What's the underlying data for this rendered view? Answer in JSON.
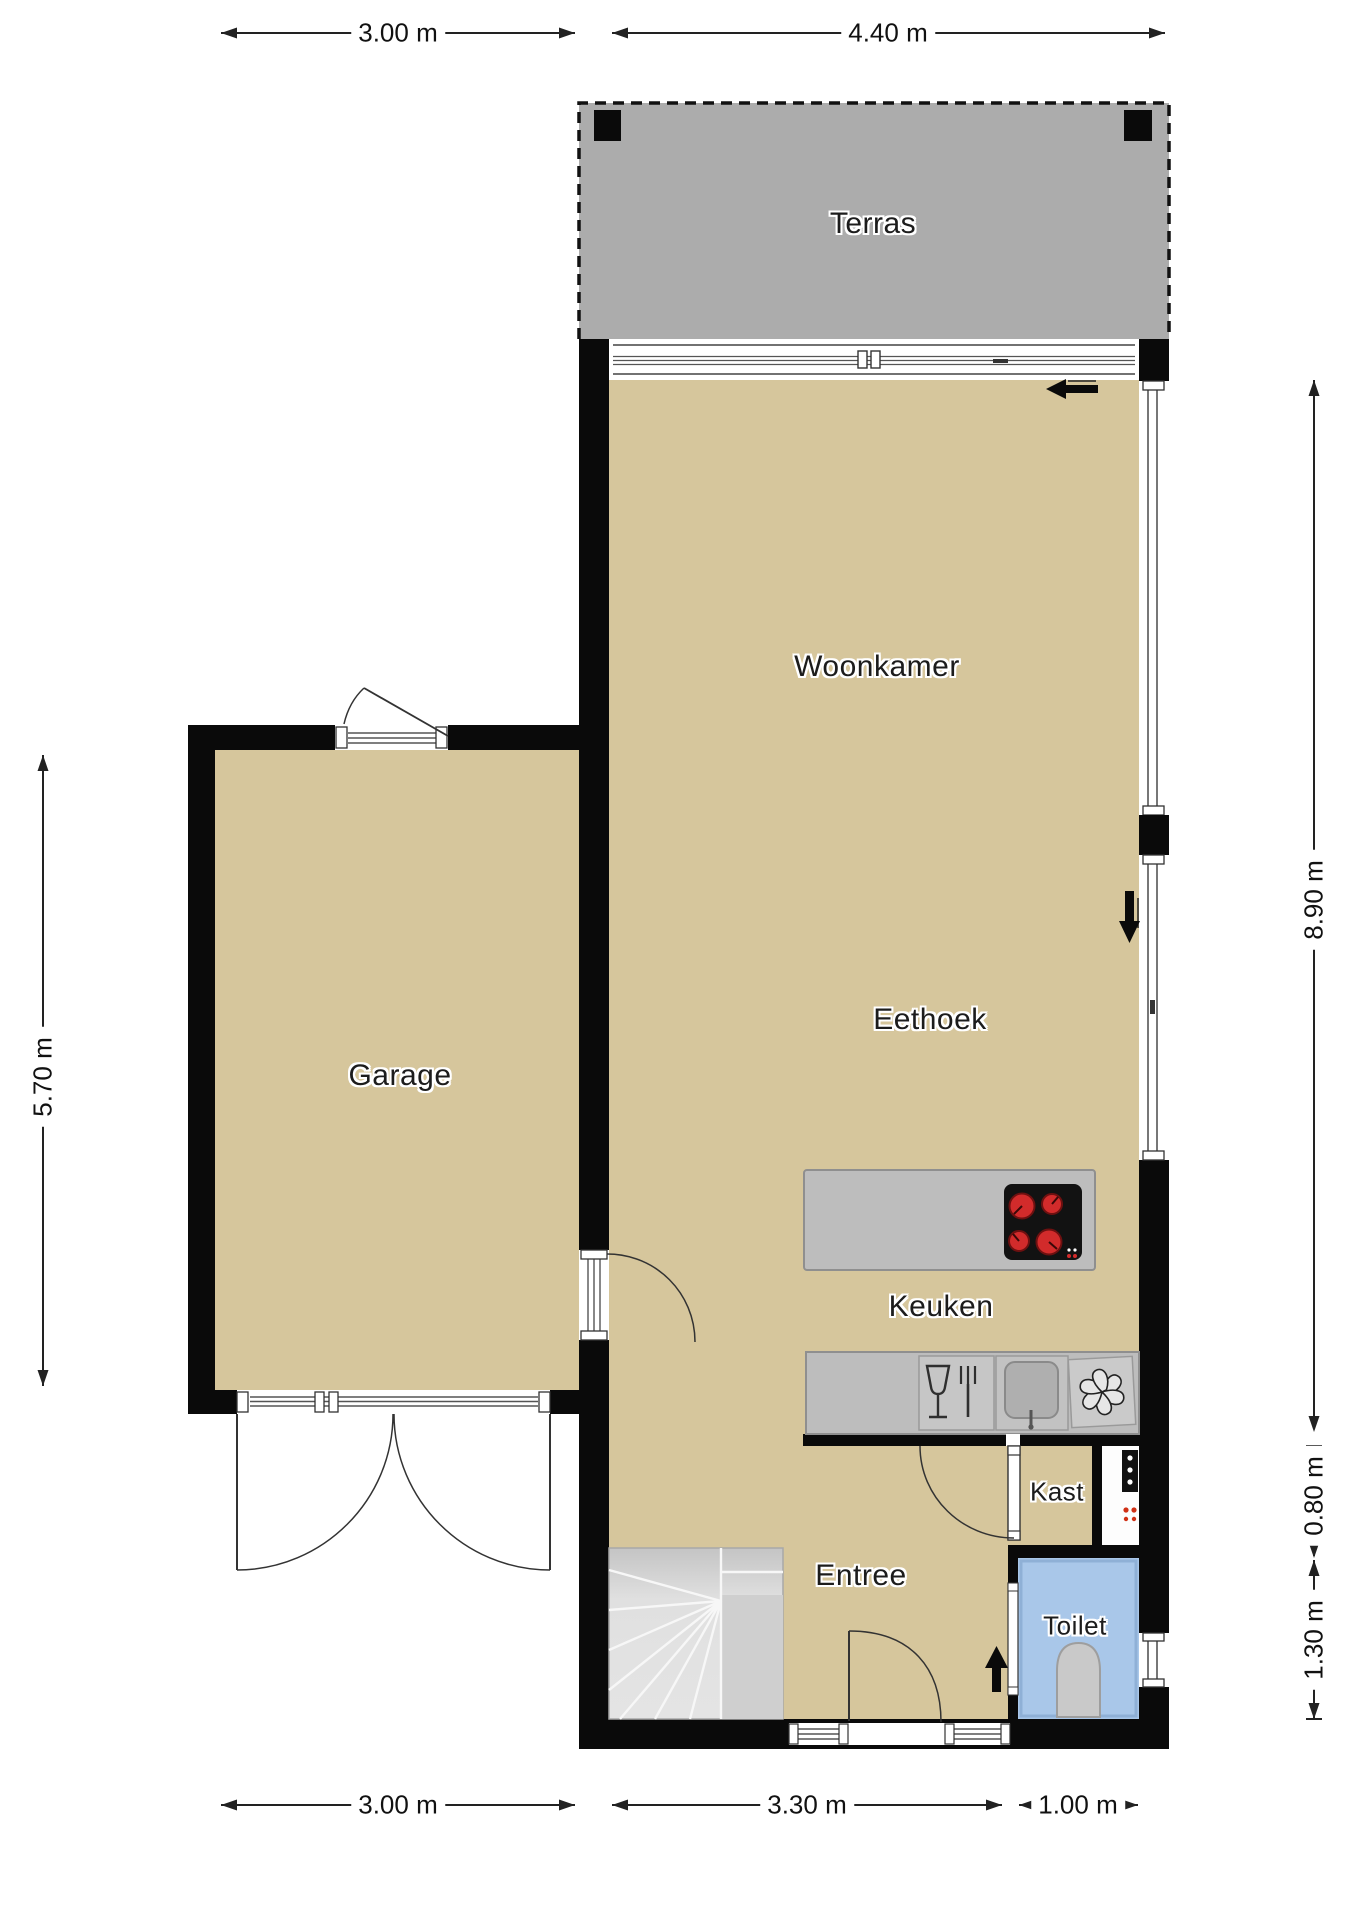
{
  "plan_title": "Floor plan (begane grond)",
  "rooms": {
    "terras": "Terras",
    "woonkamer": "Woonkamer",
    "eethoek": "Eethoek",
    "keuken": "Keuken",
    "garage": "Garage",
    "entree": "Entree",
    "kast": "Kast",
    "toilet": "Toilet"
  },
  "dims": {
    "top_garage": "3.00 m",
    "top_house": "4.40 m",
    "left_garage": "5.70 m",
    "right_living": "8.90 m",
    "right_kast": "0.80 m",
    "right_toilet": "1.30 m",
    "bottom_garage": "3.00 m",
    "bottom_entree": "3.30 m",
    "bottom_toilet": "1.00 m"
  },
  "icons": {
    "cooktop": "four-red-burners",
    "dishwasher": "glass-and-fork",
    "sink": "basin-with-faucet",
    "extractor": "fan-pinwheel",
    "meter_cabinet": "panel-with-indicator-dots",
    "toilet_fixture": "toilet-bowl",
    "entry_direction": "arrow-up",
    "slide_direction_top": "arrow-left",
    "slide_direction_right": "arrow-down",
    "terrace_posts": "black-square-posts"
  },
  "colors": {
    "floor": "#D6C69C",
    "terrace": "#ACACAC",
    "wall": "#0A0A0A",
    "counter": "#BDBDBD",
    "counter_border": "#8F8F8F",
    "stairs": "#E0E0E0",
    "toilet_room": "#A9C7E9",
    "burner_red": "#D22B2B",
    "window_line": "#555555"
  }
}
